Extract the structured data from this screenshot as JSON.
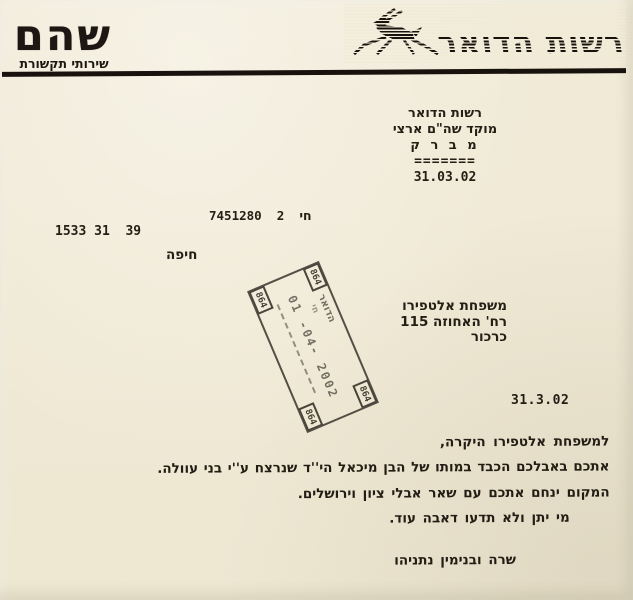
{
  "document_type": "scanned condolence telegram",
  "colors": {
    "paper": "#f0ead6",
    "ink": "#221c14",
    "stamp_ink": "#3a352d"
  },
  "header": {
    "shoham_logo": "שהם",
    "shoham_subtitle": "שירותי תקשורת",
    "postal_authority_logo": "רשות הדואר",
    "deer_icon": "leaping-deer"
  },
  "telegram_header": {
    "org": "רשות הדואר",
    "center": "מוקד שה\"ם ארצי",
    "type": "מ ב ר ק",
    "underline": "=======",
    "date": "31.03.02"
  },
  "reference": {
    "ref_line": "חי  2  7451280",
    "code_line": "1533 31  39",
    "origin_city": "חיפה"
  },
  "postmark_stamp": {
    "corner_number": "864",
    "text_line1": "הדואר",
    "text_line2": "חי",
    "date": "01 -04- 2002"
  },
  "recipient": {
    "name": "משפחת אלטפירו",
    "street": "רח' האחוזה 115",
    "city": "כרכור"
  },
  "letter": {
    "date": "31.3.02",
    "salutation": "למשפחת אלטפירו היקרה,",
    "body_line1": "אתכם באבלכם הכבד במותו של הבן מיכאל הי''ד שנרצח ע''י בני עוולה.",
    "body_line2": "המקום ינחם אתכם עם שאר אבלי ציון וירושלים.",
    "body_line3": "מי יתן ולא תדעו דאבה עוד.",
    "signature": "שרה ובנימין נתניהו"
  }
}
